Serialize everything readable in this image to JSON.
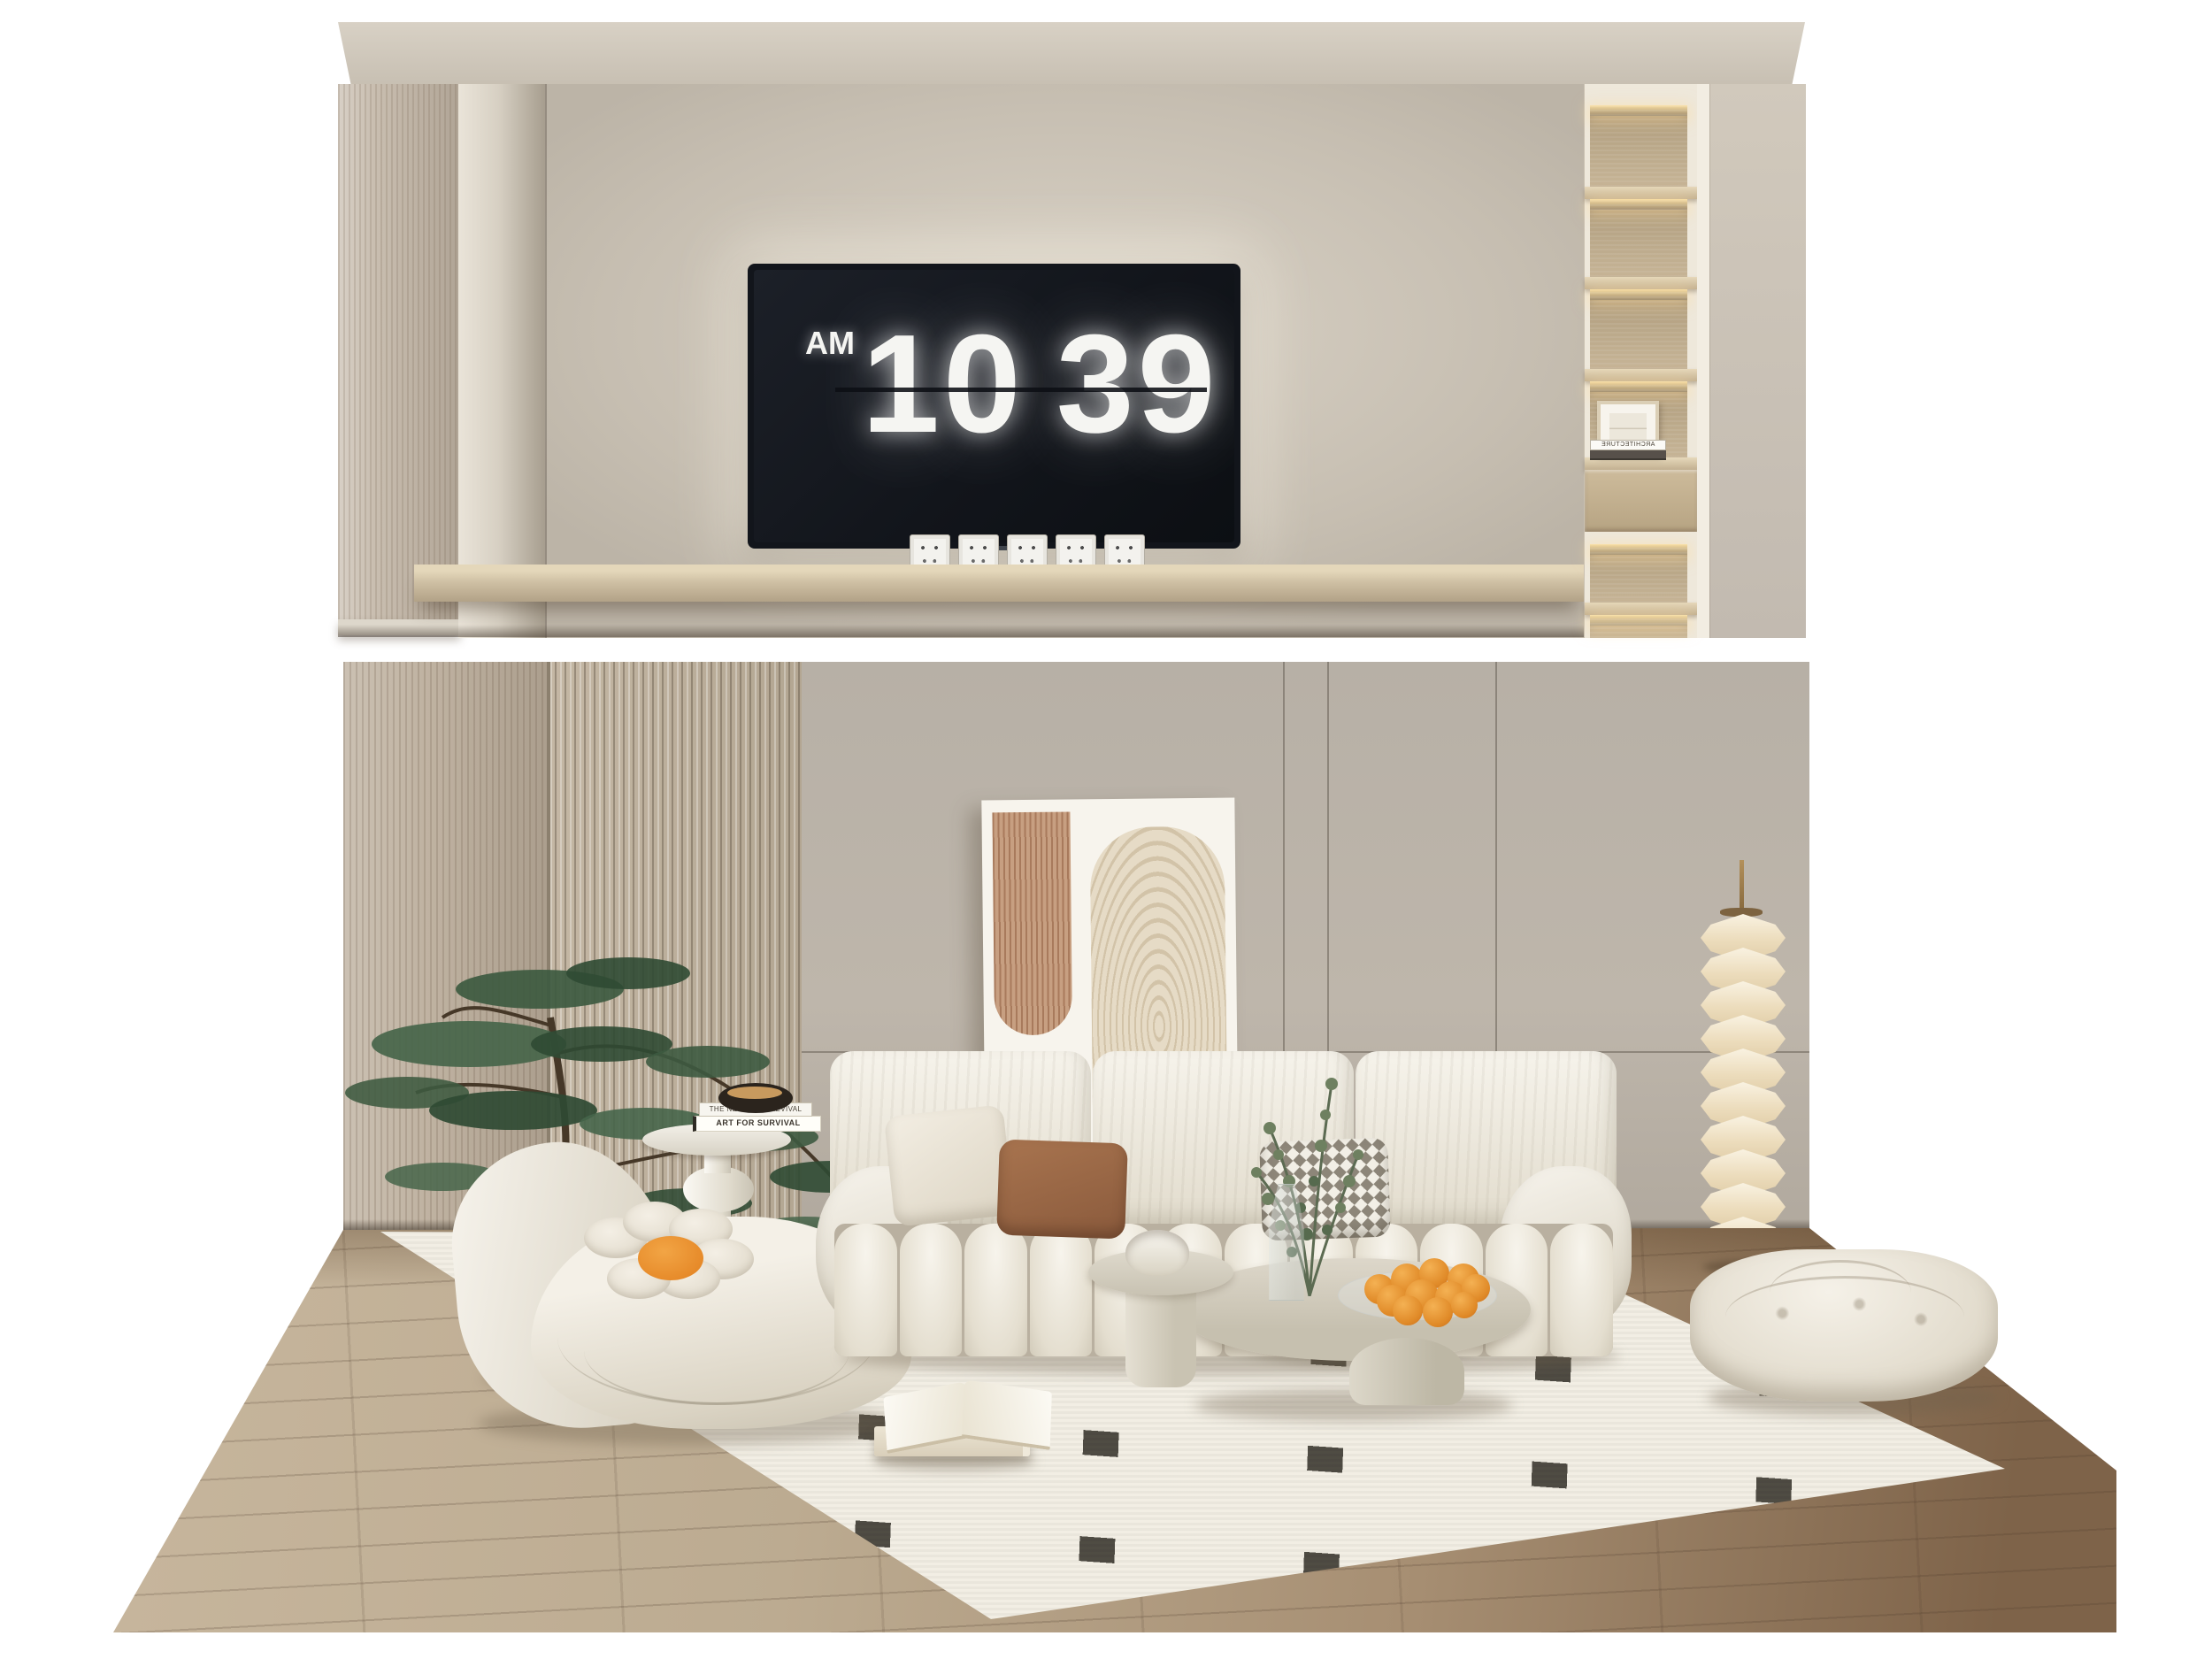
{
  "top_panel": {
    "tv_clock": {
      "meridiem": "AM",
      "hour": "10",
      "minute": "39"
    },
    "outlets": {
      "count": 5
    },
    "shelving": {
      "book_spine": "ARCHITECTURE",
      "niche_count": 6
    }
  },
  "room": {
    "side_table": {
      "book_top_spine": "THE NEW LOOK REVIVAL",
      "book_bottom_spine": "ART FOR SURVIVAL"
    },
    "sofa": {
      "back_cushions": 3,
      "seat_channels": 12,
      "pillows": [
        "cream",
        "terracotta",
        "houndstooth"
      ]
    },
    "floor_lamp": {
      "segments": 10
    },
    "fruit_bowl": {
      "count": 11
    },
    "flower_pillow": {
      "petals": 6
    }
  },
  "palette": {
    "wall_beige": "#c6beb1",
    "wall_gray": "#b7b0a6",
    "wood_light": "#c0b3a2",
    "wood_floor_dark": "#7e6349",
    "shelf_wood": "#d0c1a5",
    "led_glow": "#ffe4a8",
    "upholstery_cream": "#f4f0e7",
    "accent_terracotta": "#a8744f",
    "accent_orange": "#e78b2e",
    "foliage_green": "#3d5a40",
    "screen_black": "#12151b",
    "rug_white": "#f2eee4",
    "rug_black": "#15130f",
    "brass": "#b3905a"
  }
}
